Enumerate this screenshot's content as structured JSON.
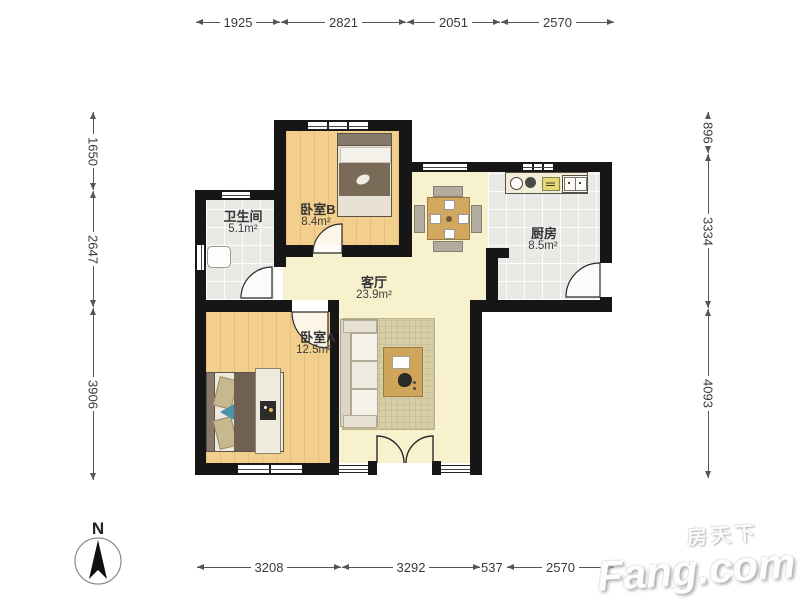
{
  "dimensions": {
    "top": [
      "1925",
      "2821",
      "2051",
      "2570"
    ],
    "bottom": [
      "3208",
      "3292",
      "537",
      "2570"
    ],
    "left": [
      "1650",
      "2647",
      "3906"
    ],
    "right": [
      "896",
      "3334",
      "4093"
    ]
  },
  "rooms": {
    "bathroom": {
      "name": "卫生间",
      "area": "5.1m²"
    },
    "bedroomB": {
      "name": "卧室B",
      "area": "8.4m²"
    },
    "kitchen": {
      "name": "厨房",
      "area": "8.5m²"
    },
    "living": {
      "name": "客厅",
      "area": "23.9m²"
    },
    "bedroomA": {
      "name": "卧室A",
      "area": "12.5m²"
    }
  },
  "compass": {
    "label": "N"
  },
  "watermark": {
    "cn": "房天下",
    "en": "Fang.com"
  },
  "colors": {
    "wall": "#161616",
    "wood_floor": "#f2cf8d",
    "living_floor": "#f8f1ce",
    "tile_floor": "#e9e9e6",
    "accent_table": "#d2a85e",
    "blanket": "#6f6152",
    "teal_accent": "#4a93a8"
  }
}
